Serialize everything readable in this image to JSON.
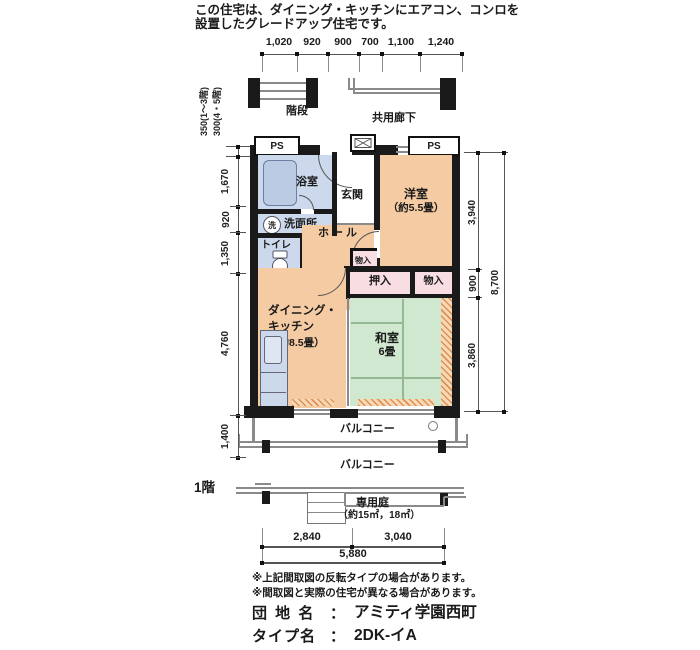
{
  "header": {
    "line1": "この住宅は、ダイニング・キッチンにエアコン、コンロを",
    "line2": "設置したグレードアップ住宅です。"
  },
  "dims": {
    "top": [
      "1,020",
      "920",
      "900",
      "700",
      "1,100",
      "1,240"
    ],
    "left_upper_a": "350(1〜3階)",
    "left_upper_b": "300(4・5階)",
    "left": [
      "1,670",
      "920",
      "1,350",
      "4,760",
      "1,400"
    ],
    "right": [
      "3,940",
      "900",
      "3,860"
    ],
    "right_total": "8,700",
    "bottom": [
      "2,840",
      "3,040"
    ],
    "bottom_total": "5,880"
  },
  "plan": {
    "stairs": "階段",
    "corridor": "共用廊下",
    "ps": "PS",
    "mb": "MB",
    "rooms": {
      "bath": "浴室",
      "wash": "洗面所",
      "wash_icon": "洗",
      "toilet": "トイレ",
      "entrance": "玄関",
      "hall": "ホール",
      "western": "洋室",
      "western_size": "（約5.5畳）",
      "dk_line1": "ダイニング・",
      "dk_line2": "キッチン",
      "dk_size": "（約8.5畳）",
      "washitsu": "和室",
      "washitsu_size": "6畳",
      "oshiire": "押入",
      "monoire": "物入",
      "monoire_small": "物入"
    },
    "balcony": "バルコニー"
  },
  "first_floor": {
    "floor_label": "1階",
    "balcony": "バルコニー",
    "garden": "専用庭",
    "garden_size": "（約15㎡，18㎡）"
  },
  "notes": [
    "※上記間取図の反転タイプの場合があります。",
    "※間取図と実際の住宅が異なる場合があります。"
  ],
  "footer": {
    "estate_label": "団 地 名",
    "colon": "：",
    "estate_value": "アミティ学園西町",
    "type_label": "タイプ名",
    "type_value": "2DK-イA"
  },
  "colors": {
    "wall": "#1a1a1a",
    "water_blue": "#ccd9ec",
    "room_peach": "#f4cba2",
    "tatami_green": "#cfe8cf",
    "closet_pink": "#f8dde3",
    "sill_orange": "#e0904f"
  }
}
